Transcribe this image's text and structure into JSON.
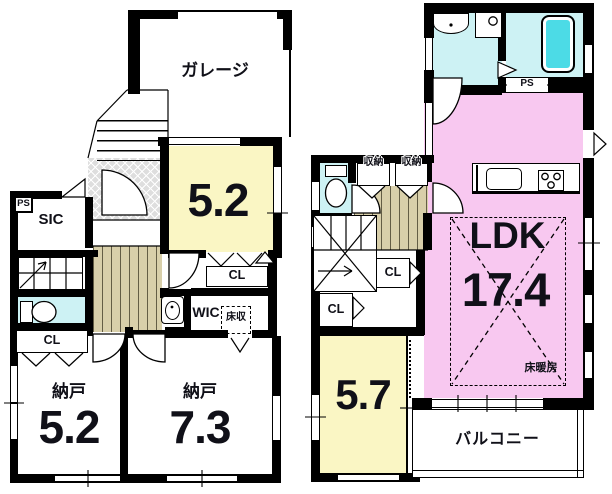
{
  "plan": {
    "floor1": {
      "garage_label": "ガレージ",
      "ps_label": "PS",
      "sic_label": "SIC",
      "closet_by_toilet": "CL",
      "room_size": "5.2",
      "room_closet": "CL",
      "wic_label": "WIC",
      "floor_storage_label": "床収",
      "storage_a_name": "納戸",
      "storage_a_size": "5.2",
      "storage_b_name": "納戸",
      "storage_b_size": "7.3"
    },
    "floor2": {
      "ps_label": "PS",
      "storage_left_label": "収納",
      "storage_right_label": "収納",
      "closet_upper": "CL",
      "closet_lower": "CL",
      "ldk_name": "LDK",
      "ldk_size": "17.4",
      "floor_heating_label": "床暖房",
      "room_size": "5.7",
      "balcony_label": "バルコニー"
    },
    "colors": {
      "room_yellow": "#FAF6C4",
      "ldk_pink": "#F8C8F0",
      "wet_area_cyan": "#CDF2F4",
      "bathtub_cyan": "#4CDBE6",
      "stairs_hall_tan": "#D8CFAA",
      "entrance_hatch_gray": "#DEDEDE",
      "wall": "#000000"
    }
  }
}
